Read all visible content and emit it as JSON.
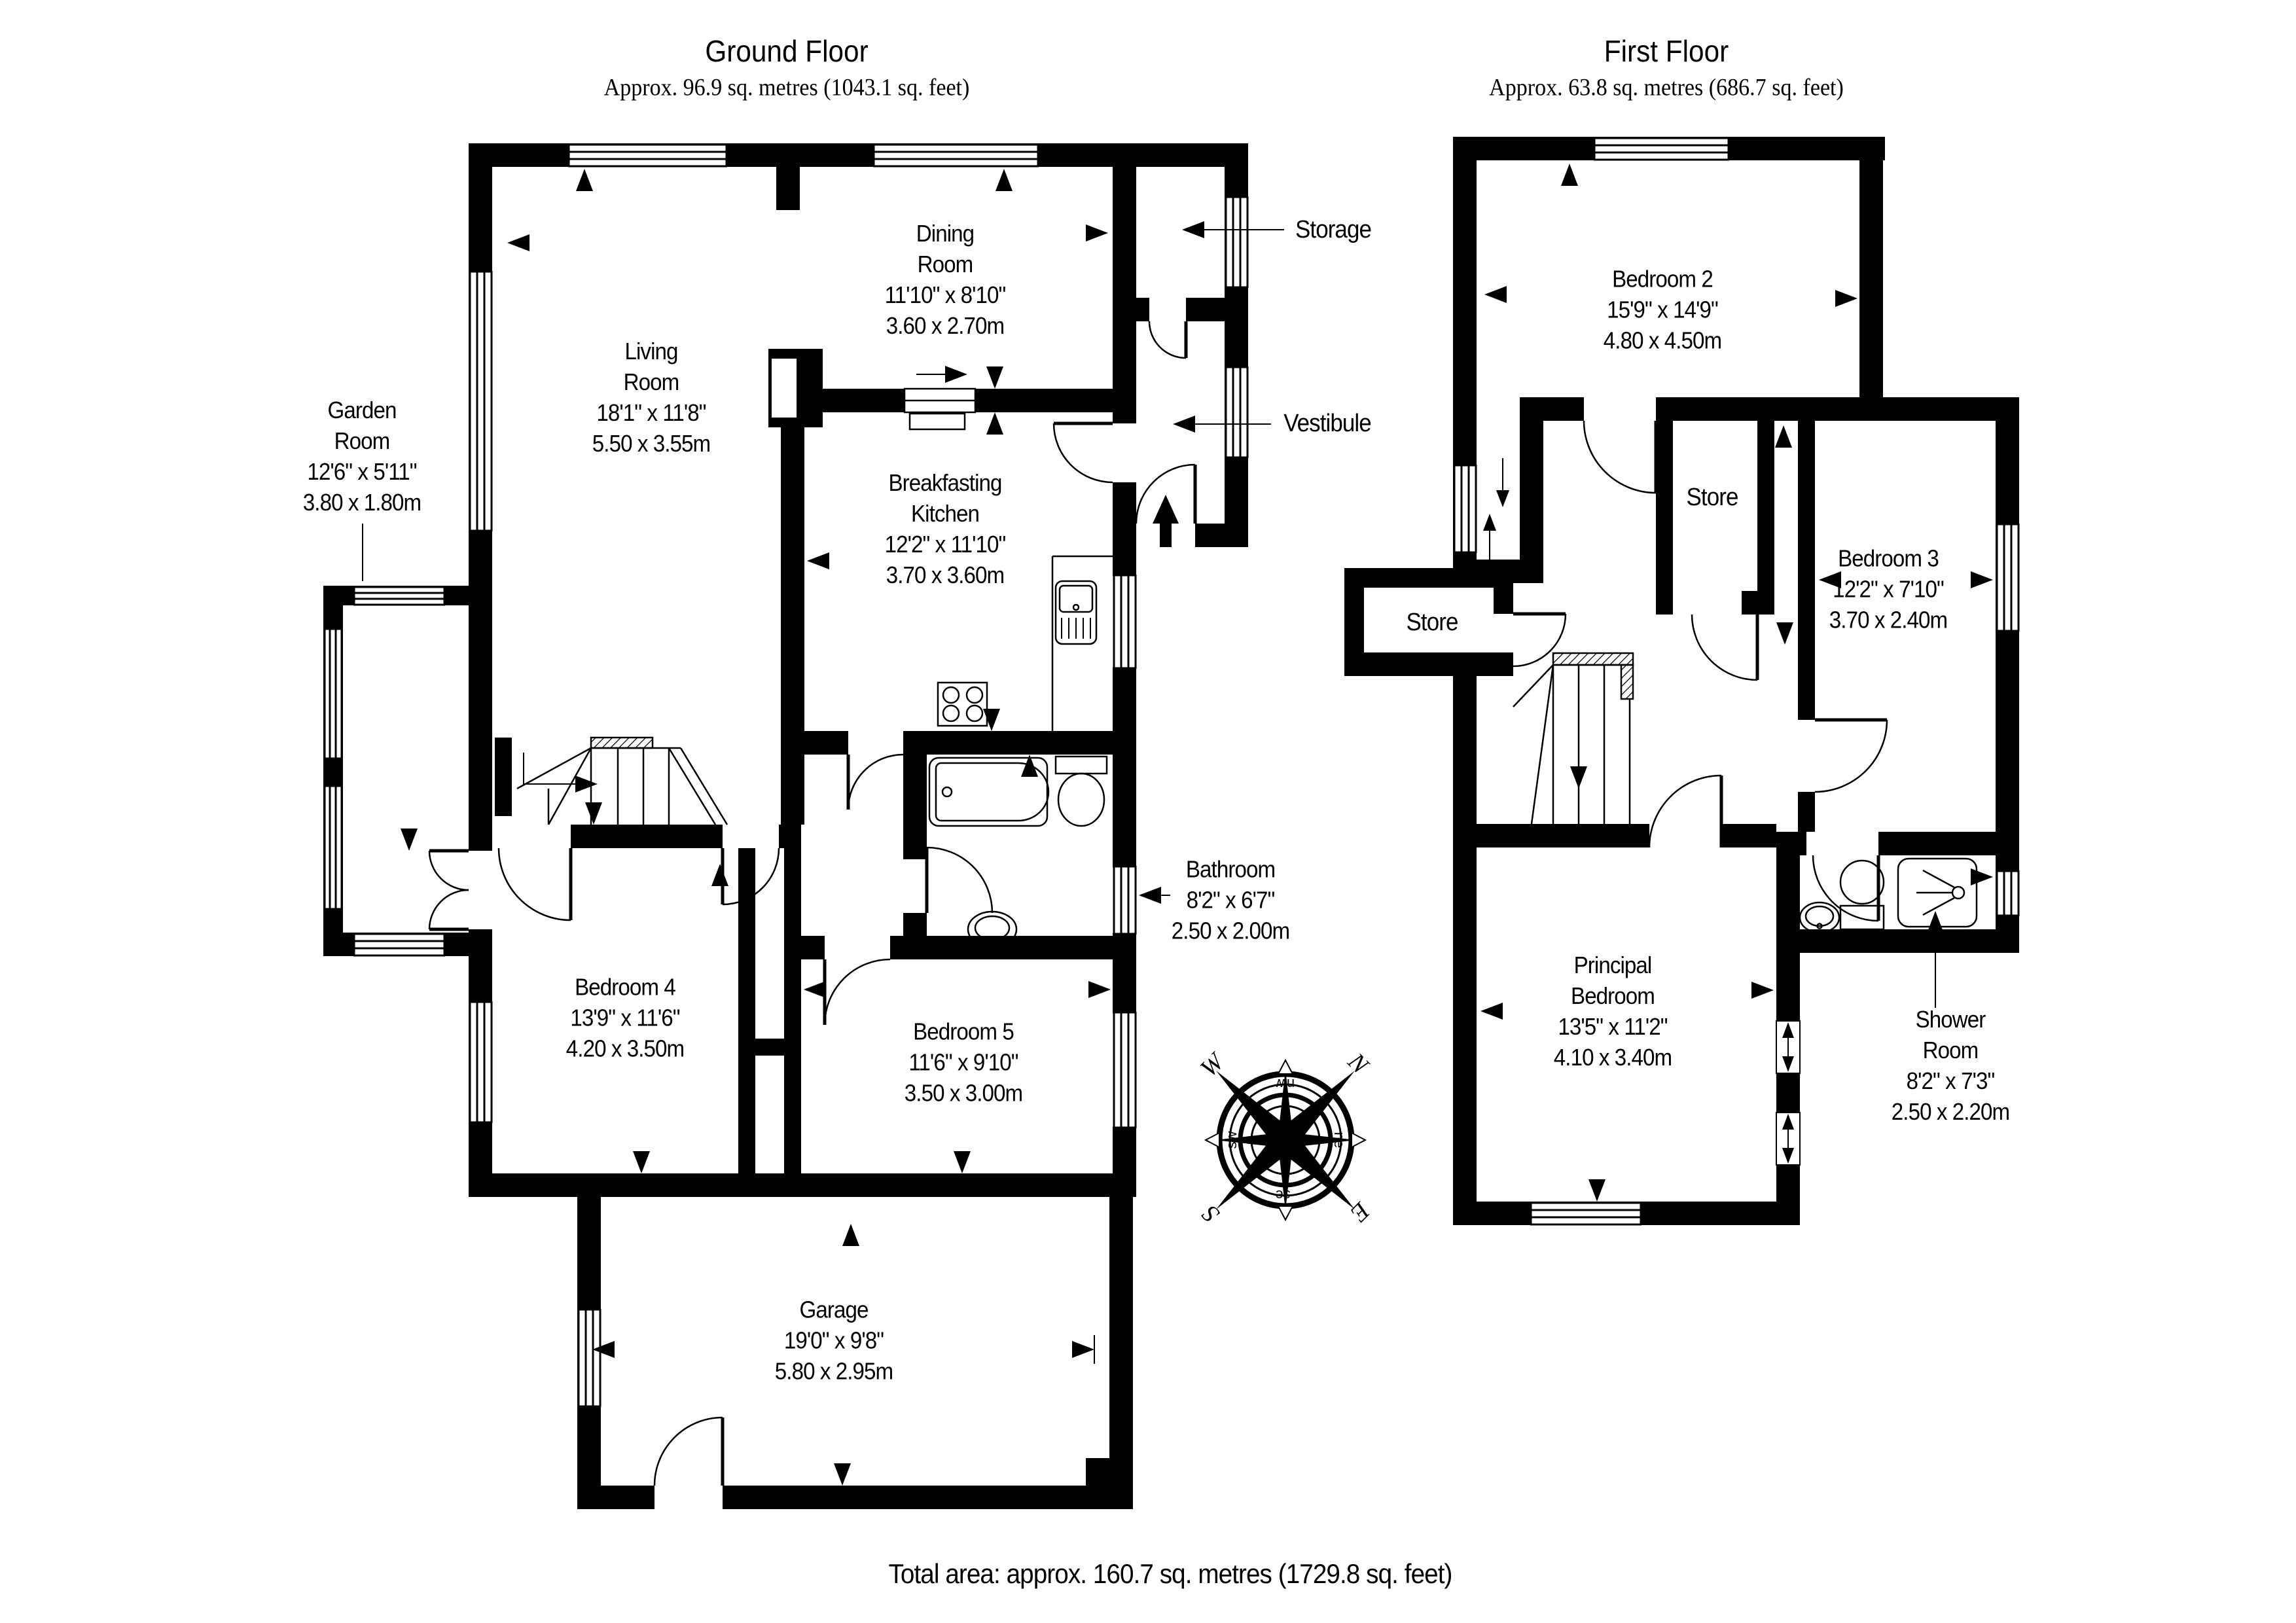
{
  "page": {
    "background": "#ffffff",
    "ink": "#000000"
  },
  "ground_floor": {
    "title": "Ground Floor",
    "subtitle": "Approx. 96.9 sq. metres (1043.1 sq. feet)",
    "rooms": {
      "garden": [
        "Garden",
        "Room",
        "12'6\" x 5'11\"",
        "3.80 x 1.80m"
      ],
      "living": [
        "Living",
        "Room",
        "18'1\" x 11'8\"",
        "5.50 x 3.55m"
      ],
      "dining": [
        "Dining",
        "Room",
        "11'10\" x 8'10\"",
        "3.60 x 2.70m"
      ],
      "storage": [
        "Storage"
      ],
      "vestibule": [
        "Vestibule"
      ],
      "kitchen": [
        "Breakfasting",
        "Kitchen",
        "12'2\" x 11'10\"",
        "3.70 x 3.60m"
      ],
      "bathroom": [
        "Bathroom",
        "8'2\" x 6'7\"",
        "2.50 x 2.00m"
      ],
      "bedroom4": [
        "Bedroom 4",
        "13'9\" x 11'6\"",
        "4.20 x 3.50m"
      ],
      "bedroom5": [
        "Bedroom 5",
        "11'6\" x 9'10\"",
        "3.50 x 3.00m"
      ],
      "garage": [
        "Garage",
        "19'0\" x 9'8\"",
        "5.80 x 2.95m"
      ]
    }
  },
  "first_floor": {
    "title": "First Floor",
    "subtitle": "Approx. 63.8 sq. metres (686.7 sq. feet)",
    "rooms": {
      "bedroom2": [
        "Bedroom 2",
        "15'9\" x 14'9\"",
        "4.80 x 4.50m"
      ],
      "store_center": [
        "Store"
      ],
      "store_left": [
        "Store"
      ],
      "bedroom3": [
        "Bedroom 3",
        "12'2\" x 7'10\"",
        "3.70 x 2.40m"
      ],
      "principal": [
        "Principal",
        "Bedroom",
        "13'5\" x 11'2\"",
        "4.10 x 3.40m"
      ],
      "shower": [
        "Shower",
        "Room",
        "8'2\" x 7'3\"",
        "2.50 x 2.20m"
      ]
    }
  },
  "compass": {
    "n": "N",
    "e": "E",
    "s": "S",
    "w": "W",
    "nw": "nw",
    "ne": "ne",
    "se": "se",
    "sw": "sw"
  },
  "footer": {
    "total_area": "Total area: approx. 160.7 sq. metres (1729.8 sq. feet)"
  }
}
